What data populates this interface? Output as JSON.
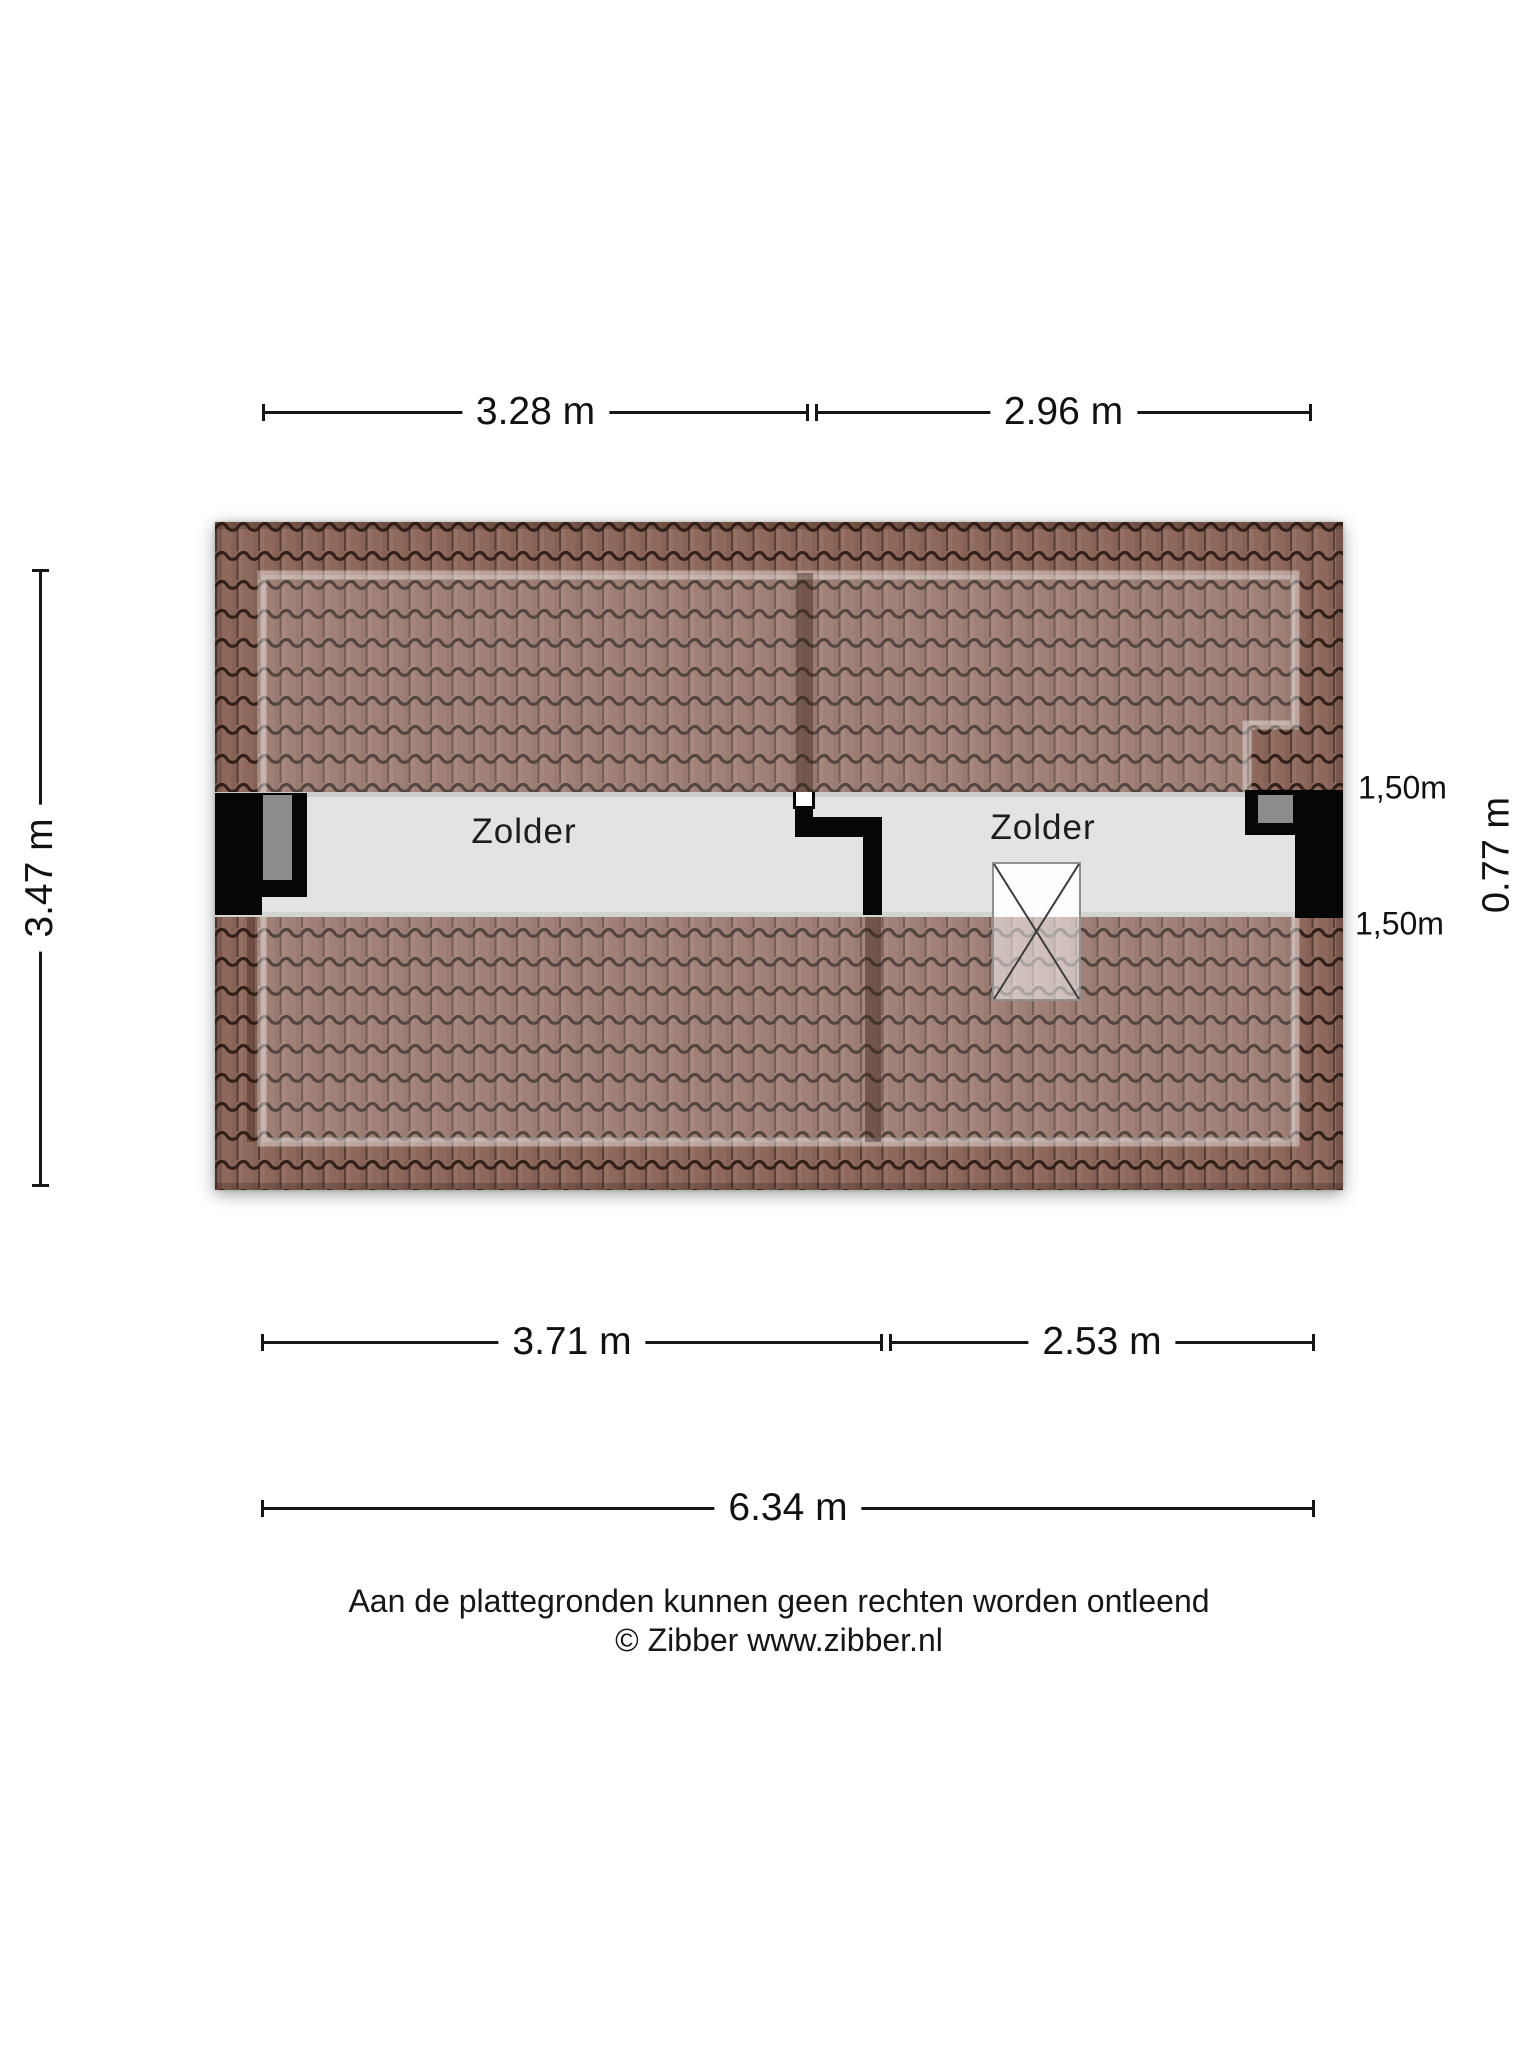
{
  "page": {
    "background": "#ffffff"
  },
  "rooms": [
    {
      "name": "Zolder"
    },
    {
      "name": "Zolder"
    }
  ],
  "dimensions": {
    "top": [
      {
        "label": "3.28 m"
      },
      {
        "label": "2.96 m"
      }
    ],
    "bottom": [
      {
        "label": "3.71 m"
      },
      {
        "label": "2.53 m"
      }
    ],
    "overall_width": {
      "label": "6.34 m"
    },
    "left_height": {
      "label": "3.47 m"
    },
    "right": {
      "top": "1,50m",
      "middle": "0.77 m",
      "bottom": "1,50m"
    }
  },
  "footer": {
    "disclaimer": "Aan de plattegronden kunnen geen rechten worden ontleend",
    "credit": "© Zibber www.zibber.nl"
  },
  "colors": {
    "roof_tile": "#8f685c",
    "roof_tile_line": "#31211a",
    "roof_inner_overlay": "rgba(255,255,255,0.17)",
    "floor": "#e3e3e2",
    "wall": "#060606",
    "wall_inset": "#8c8c8c",
    "dimension_text": "#111111"
  }
}
